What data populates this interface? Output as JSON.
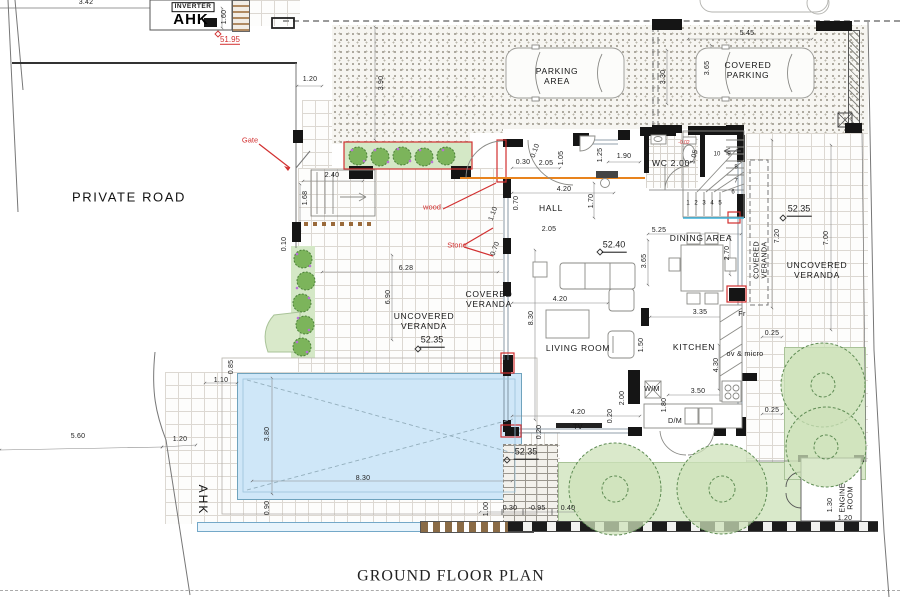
{
  "title": "GROUND FLOOR PLAN",
  "colors": {
    "annotation_red": "#d23030",
    "beam_orange": "#e8831d",
    "pool_blue": "#cfe7f8",
    "garden_green": "#d9e9ca",
    "wall_black": "#151515",
    "stair_nosing_cyan": "#3bb0d8"
  },
  "rooms": [
    "HALL",
    "LIVING ROOM",
    "DINING AREA",
    "KITCHEN",
    "WC 2.00",
    "ENGINE ROOM"
  ],
  "areas": [
    "PRIVATE ROAD",
    "PARKING AREA",
    "COVERED PARKING",
    "COVERED VERANDA",
    "UNCOVERED VERANDA"
  ],
  "levels": [
    "51.95",
    "52.35",
    "52.40",
    "-0.95",
    "-0.02"
  ],
  "labels": [
    {
      "n": "dim-3-42",
      "t": "3.42",
      "x": 86,
      "y": 3,
      "c": "d"
    },
    {
      "n": "inverter-label",
      "t": "INVERTER",
      "x": 193,
      "y": 7,
      "c": "bx"
    },
    {
      "n": "ahk-label-top",
      "t": "AHK",
      "x": 191,
      "y": 20,
      "c": "ahk"
    },
    {
      "n": "dim-1-60",
      "t": "1.60",
      "x": 225,
      "y": 17,
      "r": -90,
      "c": "d"
    },
    {
      "n": "level-51-95",
      "t": "51.95",
      "x": 230,
      "y": 40,
      "c": "lvr"
    },
    {
      "n": "private-road-label",
      "t": "PRIVATE ROAD",
      "x": 129,
      "y": 197,
      "c": "big"
    },
    {
      "n": "gate-note",
      "t": "Gate",
      "x": 250,
      "y": 141,
      "c": "dr"
    },
    {
      "n": "dim-1-20-top",
      "t": "1.20",
      "x": 310,
      "y": 80,
      "c": "d"
    },
    {
      "n": "dim-3-90",
      "t": "3.90",
      "x": 382,
      "y": 83,
      "r": -90,
      "c": "d"
    },
    {
      "n": "parking-area-label",
      "t": "PARKING\nAREA",
      "x": 557,
      "y": 76,
      "c": "rm"
    },
    {
      "n": "dim-5-45",
      "t": "5.45",
      "x": 747,
      "y": 34,
      "c": "d"
    },
    {
      "n": "dim-3-30",
      "t": "3.30",
      "x": 664,
      "y": 77,
      "r": -90,
      "c": "d"
    },
    {
      "n": "dim-3-65-parking",
      "t": "3.65",
      "x": 708,
      "y": 68,
      "r": -90,
      "c": "d"
    },
    {
      "n": "covered-parking-label",
      "t": "COVERED\nPARKING",
      "x": 748,
      "y": 70,
      "c": "rm"
    },
    {
      "n": "dim-2-40",
      "t": "2.40",
      "x": 332,
      "y": 176,
      "c": "d"
    },
    {
      "n": "dim-1-68",
      "t": "1.68",
      "x": 306,
      "y": 198,
      "r": -90,
      "c": "d"
    },
    {
      "n": "wood-note",
      "t": "wood",
      "x": 432,
      "y": 208,
      "c": "dr"
    },
    {
      "n": "stone-note",
      "t": "Stone",
      "x": 457,
      "y": 246,
      "c": "dr"
    },
    {
      "n": "dim-0-10-left",
      "t": "0.10",
      "x": 285,
      "y": 244,
      "r": -90,
      "c": "d"
    },
    {
      "n": "dim-6-28",
      "t": "6.28",
      "x": 406,
      "y": 269,
      "c": "d"
    },
    {
      "n": "dim-6-90",
      "t": "6.90",
      "x": 389,
      "y": 297,
      "r": -90,
      "c": "d"
    },
    {
      "n": "uncovered-veranda-left-label",
      "t": "UNCOVERED\nVERANDA",
      "x": 424,
      "y": 321,
      "c": "rm"
    },
    {
      "n": "level-52-35-left",
      "t": "52.35",
      "x": 432,
      "y": 341,
      "c": "lv"
    },
    {
      "n": "covered-veranda-left-label",
      "t": "COVERED\nVERANDA",
      "x": 489,
      "y": 299,
      "c": "rm"
    },
    {
      "n": "dim-8-30-left",
      "t": "8.30",
      "x": 532,
      "y": 318,
      "r": -90,
      "c": "d"
    },
    {
      "n": "dim-0-30-hall",
      "t": "0.30",
      "x": 523,
      "y": 163,
      "c": "d"
    },
    {
      "n": "dim-2-05-hall-top",
      "t": "2.05",
      "x": 546,
      "y": 164,
      "c": "d"
    },
    {
      "n": "dim-0-10-hall",
      "t": "0.10",
      "x": 536,
      "y": 151,
      "r": -70,
      "c": "d"
    },
    {
      "n": "dim-1-05-hall",
      "t": "1.05",
      "x": 562,
      "y": 158,
      "r": -90,
      "c": "d"
    },
    {
      "n": "dim-1-25-wc",
      "t": "1.25",
      "x": 601,
      "y": 155,
      "r": -90,
      "c": "d"
    },
    {
      "n": "dim-1-90",
      "t": "1.90",
      "x": 624,
      "y": 157,
      "c": "d"
    },
    {
      "n": "wc-label",
      "t": "WC 2.00",
      "x": 671,
      "y": 163,
      "c": "rm"
    },
    {
      "n": "dim-1-05-wc",
      "t": "1.05",
      "x": 695,
      "y": 157,
      "r": -75,
      "c": "d"
    },
    {
      "n": "level-note-wc",
      "t": "-0.02",
      "x": 684,
      "y": 144,
      "c": "ty"
    },
    {
      "n": "dim-4-20-hall",
      "t": "4.20",
      "x": 564,
      "y": 190,
      "c": "d"
    },
    {
      "n": "dim-1-70-hall",
      "t": "1.70",
      "x": 592,
      "y": 201,
      "r": -90,
      "c": "d"
    },
    {
      "n": "hall-label",
      "t": "HALL",
      "x": 551,
      "y": 208,
      "c": "rm"
    },
    {
      "n": "dim-0-70-hall",
      "t": "0.70",
      "x": 517,
      "y": 203,
      "r": -90,
      "c": "d"
    },
    {
      "n": "dim-2-05-hall2",
      "t": "2.05",
      "x": 549,
      "y": 230,
      "c": "d"
    },
    {
      "n": "dim-1-10-door",
      "t": "1.10",
      "x": 494,
      "y": 214,
      "r": -70,
      "c": "d"
    },
    {
      "n": "dim-0-70-stone",
      "t": "0.70",
      "x": 496,
      "y": 249,
      "r": -70,
      "c": "d"
    },
    {
      "n": "dim-5-25",
      "t": "5.25",
      "x": 659,
      "y": 231,
      "c": "d"
    },
    {
      "n": "level-52-40",
      "t": "52.40",
      "x": 614,
      "y": 246,
      "c": "lv"
    },
    {
      "n": "dining-area-label",
      "t": "DINING AREA",
      "x": 701,
      "y": 238,
      "c": "rm"
    },
    {
      "n": "dim-3-65-dining",
      "t": "3.65",
      "x": 645,
      "y": 261,
      "r": -90,
      "c": "d"
    },
    {
      "n": "dim-2-70-dining",
      "t": "2.70",
      "x": 728,
      "y": 253,
      "r": -90,
      "c": "d"
    },
    {
      "n": "dim-4-20-living",
      "t": "4.20",
      "x": 560,
      "y": 300,
      "c": "d"
    },
    {
      "n": "living-room-label",
      "t": "LIVING ROOM",
      "x": 578,
      "y": 348,
      "c": "rm"
    },
    {
      "n": "dim-1-50",
      "t": "1.50",
      "x": 642,
      "y": 345,
      "r": -90,
      "c": "d"
    },
    {
      "n": "kitchen-label",
      "t": "KITCHEN",
      "x": 694,
      "y": 347,
      "c": "rm"
    },
    {
      "n": "dim-3-35",
      "t": "3.35",
      "x": 700,
      "y": 313,
      "c": "d"
    },
    {
      "n": "fridge-label",
      "t": "Fr",
      "x": 742,
      "y": 314,
      "c": "rs"
    },
    {
      "n": "oven-micro-label",
      "t": "ov & micro",
      "x": 745,
      "y": 354,
      "c": "rs"
    },
    {
      "n": "dim-4-30",
      "t": "4.30",
      "x": 717,
      "y": 365,
      "r": -90,
      "c": "d"
    },
    {
      "n": "washing-machine-label",
      "t": "W/M",
      "x": 652,
      "y": 389,
      "c": "rs"
    },
    {
      "n": "dim-3-50",
      "t": "3.50",
      "x": 698,
      "y": 392,
      "c": "d"
    },
    {
      "n": "dim-1-80",
      "t": "1.80",
      "x": 665,
      "y": 405,
      "r": -90,
      "c": "d"
    },
    {
      "n": "dim-2-00",
      "t": "2.00",
      "x": 623,
      "y": 398,
      "r": -90,
      "c": "d"
    },
    {
      "n": "dishwasher-label",
      "t": "D/M",
      "x": 675,
      "y": 421,
      "c": "rs"
    },
    {
      "n": "dim-4-20-bottom",
      "t": "4.20",
      "x": 578,
      "y": 413,
      "c": "d"
    },
    {
      "n": "dim-0-20-a",
      "t": "0.20",
      "x": 611,
      "y": 416,
      "r": -90,
      "c": "d"
    },
    {
      "n": "dim-0-20-b",
      "t": "0.20",
      "x": 540,
      "y": 432,
      "r": -90,
      "c": "d"
    },
    {
      "n": "tv-label",
      "t": "TV",
      "x": 578,
      "y": 427,
      "c": "rs"
    },
    {
      "n": "dim-0-25-a",
      "t": "0.25",
      "x": 772,
      "y": 334,
      "c": "d"
    },
    {
      "n": "dim-0-25-b",
      "t": "0.25",
      "x": 772,
      "y": 411,
      "c": "d"
    },
    {
      "n": "level-52-35-deck",
      "t": "52.35",
      "x": 526,
      "y": 453,
      "c": "lv"
    },
    {
      "n": "dim-1-00",
      "t": "1.00",
      "x": 487,
      "y": 509,
      "r": -90,
      "c": "d"
    },
    {
      "n": "dim-0-30-deck",
      "t": "0.30",
      "x": 510,
      "y": 509,
      "c": "d"
    },
    {
      "n": "level-minus-0-95",
      "t": "-0.95",
      "x": 537,
      "y": 509,
      "c": "d"
    },
    {
      "n": "dim-0-40",
      "t": "0.40",
      "x": 568,
      "y": 509,
      "c": "d"
    },
    {
      "n": "dim-0-90",
      "t": "0.90",
      "x": 268,
      "y": 508,
      "r": -90,
      "c": "d"
    },
    {
      "n": "dim-8-30-pool",
      "t": "8.30",
      "x": 363,
      "y": 479,
      "c": "d"
    },
    {
      "n": "dim-3-80",
      "t": "3.80",
      "x": 268,
      "y": 434,
      "r": -90,
      "c": "d"
    },
    {
      "n": "dim-0-85",
      "t": "0.85",
      "x": 232,
      "y": 367,
      "r": -90,
      "c": "d"
    },
    {
      "n": "dim-1-10-pool",
      "t": "1.10",
      "x": 221,
      "y": 381,
      "c": "d"
    },
    {
      "n": "dim-1-20-road",
      "t": "1.20",
      "x": 180,
      "y": 440,
      "c": "d"
    },
    {
      "n": "dim-5-60",
      "t": "5.60",
      "x": 78,
      "y": 437,
      "c": "d"
    },
    {
      "n": "ahk-label-bottom",
      "t": "AHK",
      "x": 203,
      "y": 500,
      "r": 90,
      "c": "ahk2"
    },
    {
      "n": "level-52-35-right",
      "t": "52.35",
      "x": 799,
      "y": 210,
      "c": "lv"
    },
    {
      "n": "dim-7-20",
      "t": "7.20",
      "x": 778,
      "y": 236,
      "r": -90,
      "c": "d"
    },
    {
      "n": "dim-7-00",
      "t": "7.00",
      "x": 827,
      "y": 238,
      "r": -90,
      "c": "d"
    },
    {
      "n": "covered-veranda-right-label",
      "t": "COVERED\nVERANDA",
      "x": 761,
      "y": 260,
      "r": -90,
      "c": "rs"
    },
    {
      "n": "uncovered-veranda-right-label",
      "t": "UNCOVERED\nVERANDA",
      "x": 817,
      "y": 270,
      "c": "rm"
    },
    {
      "n": "engine-room-label",
      "t": "ENGINE\nROOM",
      "x": 847,
      "y": 498,
      "r": -90,
      "c": "rs"
    },
    {
      "n": "dim-1-30",
      "t": "1.30",
      "x": 831,
      "y": 505,
      "r": -90,
      "c": "d"
    },
    {
      "n": "dim-1-20-engine",
      "t": "1.20",
      "x": 845,
      "y": 519,
      "c": "d"
    },
    {
      "n": "plan-title",
      "t": "GROUND FLOOR PLAN",
      "x": 451,
      "y": 577,
      "c": "ti"
    },
    {
      "n": "stair-1",
      "t": "1",
      "x": 688,
      "y": 204,
      "c": "st"
    },
    {
      "n": "stair-2",
      "t": "2",
      "x": 696,
      "y": 204,
      "c": "st"
    },
    {
      "n": "stair-3",
      "t": "3",
      "x": 704,
      "y": 204,
      "c": "st"
    },
    {
      "n": "stair-4",
      "t": "4",
      "x": 712,
      "y": 204,
      "c": "st"
    },
    {
      "n": "stair-5",
      "t": "5",
      "x": 720,
      "y": 204,
      "c": "st"
    },
    {
      "n": "stair-6",
      "t": "6",
      "x": 733,
      "y": 193,
      "c": "st"
    },
    {
      "n": "stair-7",
      "t": "7",
      "x": 736,
      "y": 182,
      "c": "st"
    },
    {
      "n": "stair-8",
      "t": "8",
      "x": 736,
      "y": 168,
      "c": "st"
    },
    {
      "n": "stair-9",
      "t": "9",
      "x": 729,
      "y": 155,
      "c": "st"
    },
    {
      "n": "stair-10",
      "t": "10",
      "x": 717,
      "y": 155,
      "c": "st"
    }
  ]
}
